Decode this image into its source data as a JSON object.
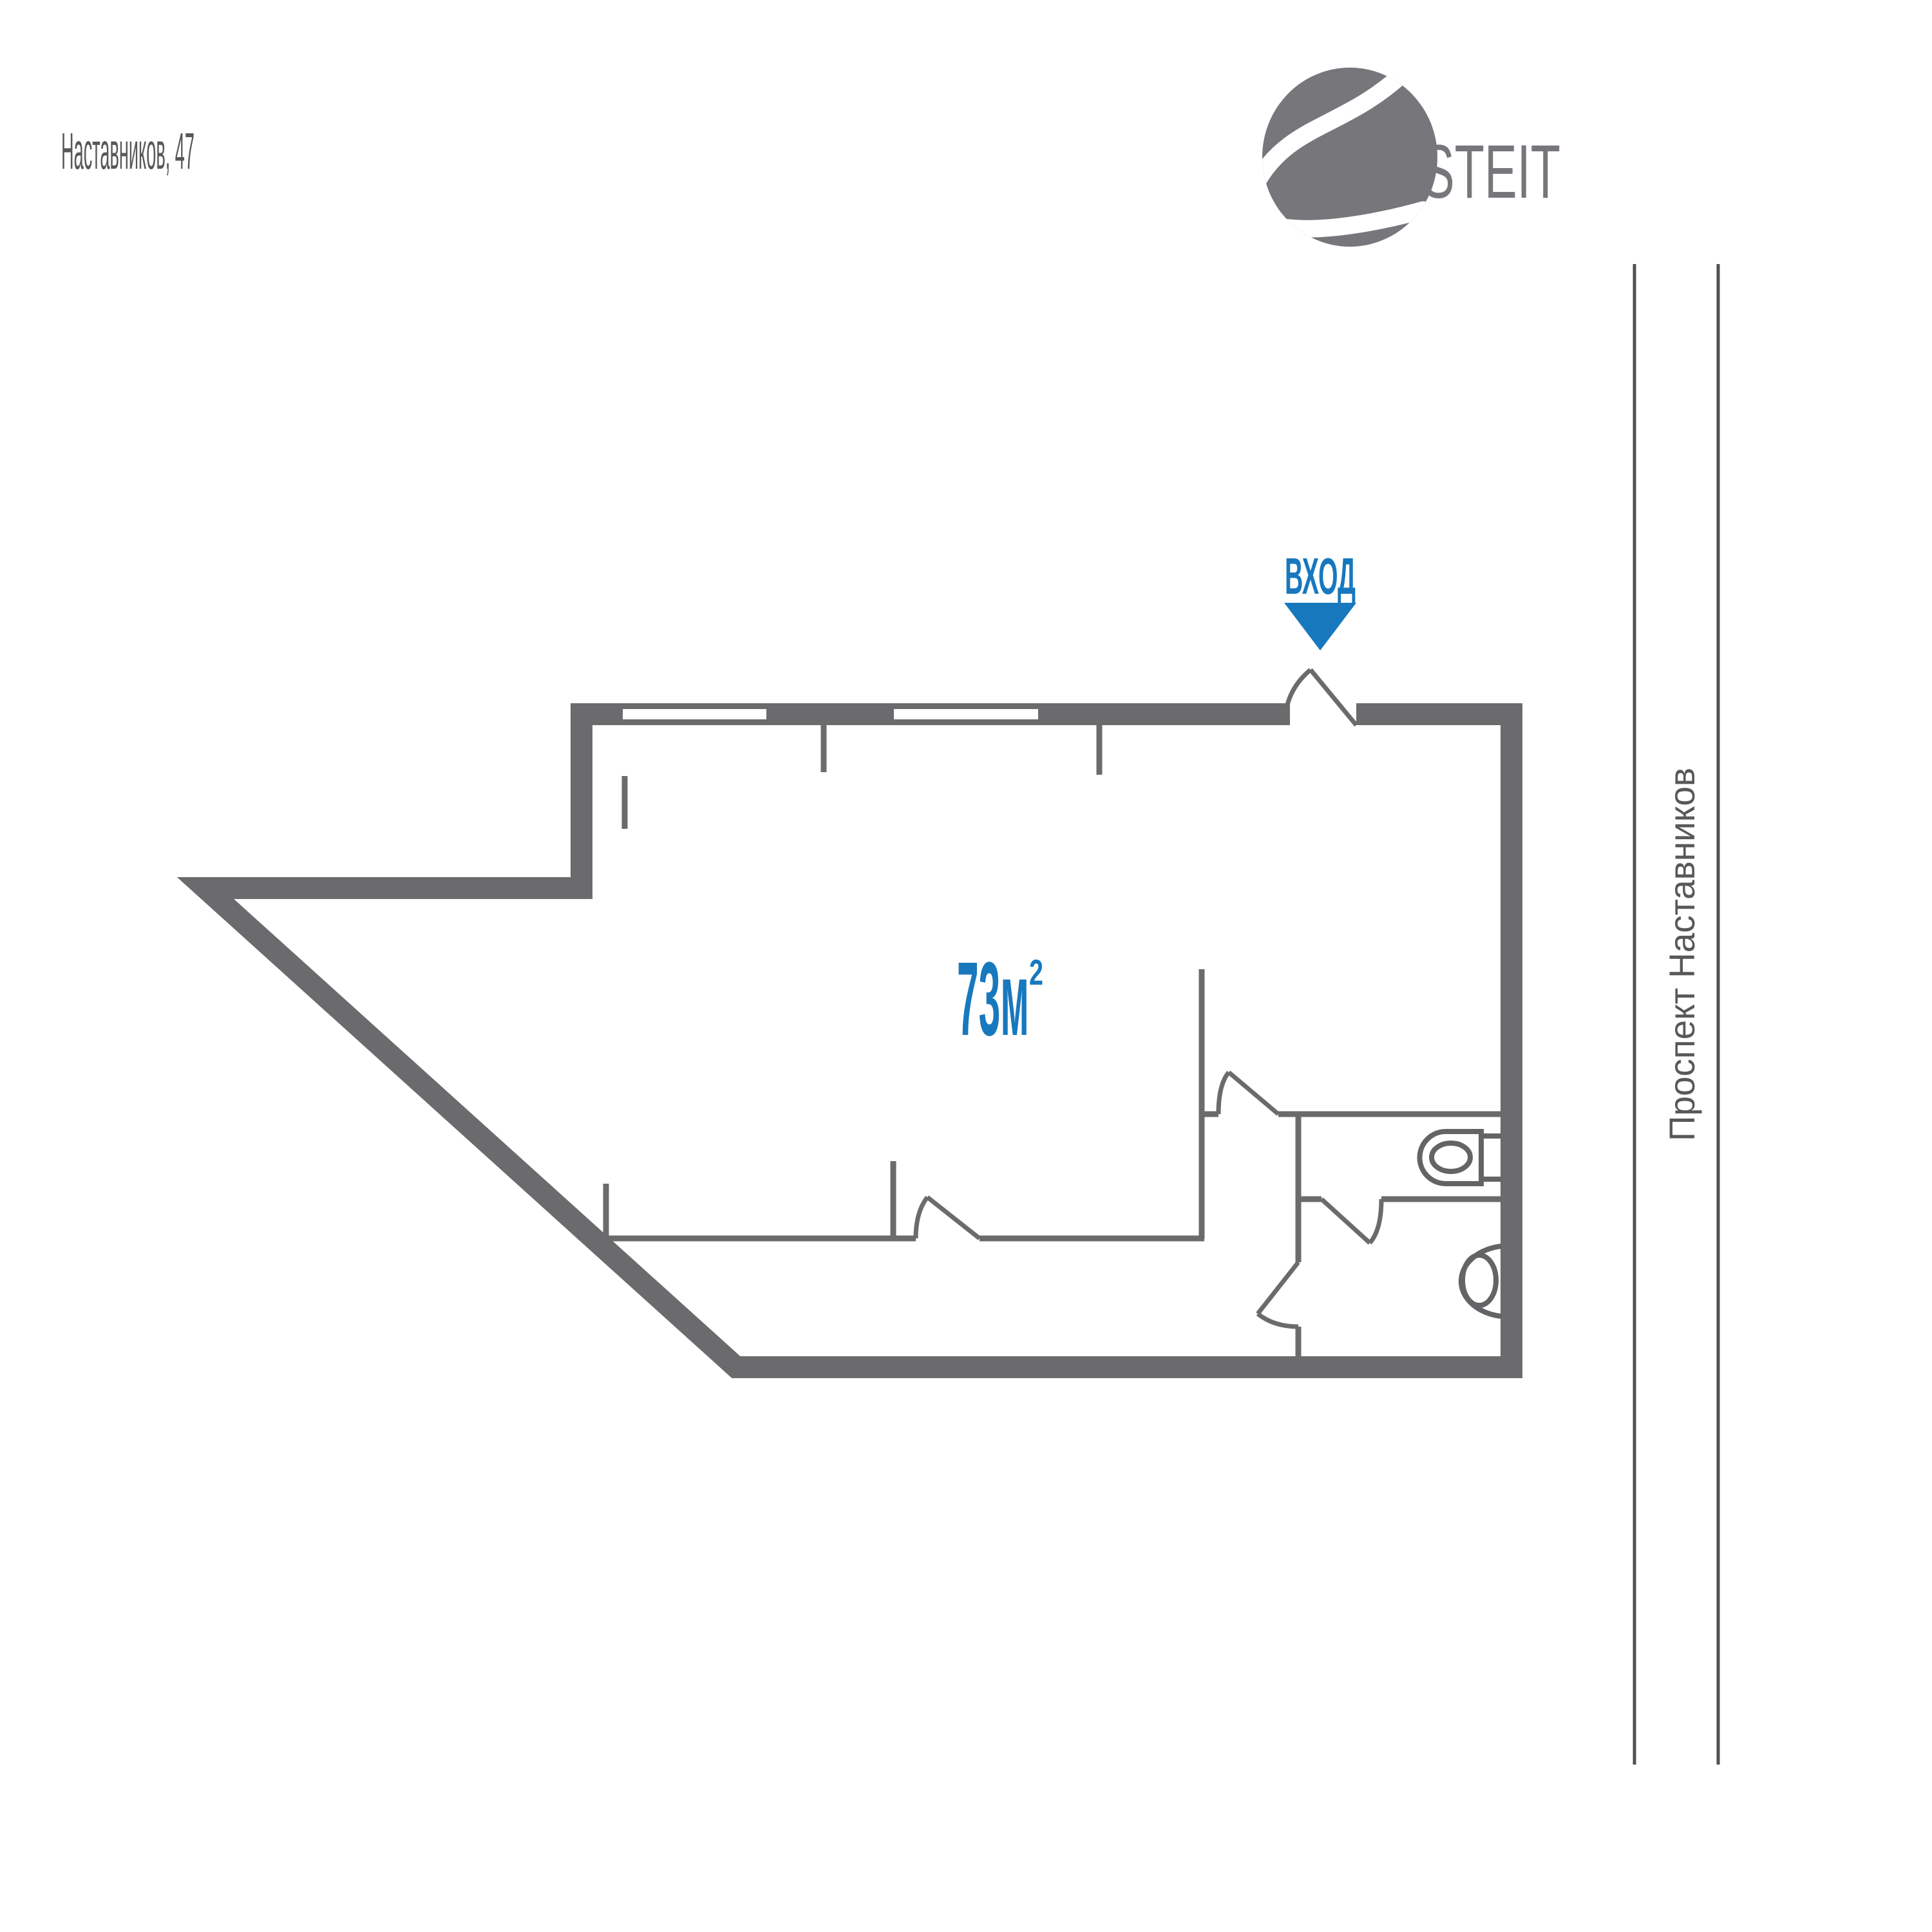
{
  "header": {
    "address": "Наставников, 47"
  },
  "logo": {
    "brand": "STEIT"
  },
  "plan": {
    "entrance_label": "ВХОД",
    "area_value": "73м",
    "area_superscript": "2"
  },
  "street": {
    "name": "Проспект Наставников"
  },
  "colors": {
    "wall_gray": "#6b6b6d",
    "fixture_gray": "#646467",
    "accent_blue": "#1878be",
    "logo_gray": "#77767b",
    "text_gray": "#58585a",
    "street_line_gray": "#515154"
  }
}
